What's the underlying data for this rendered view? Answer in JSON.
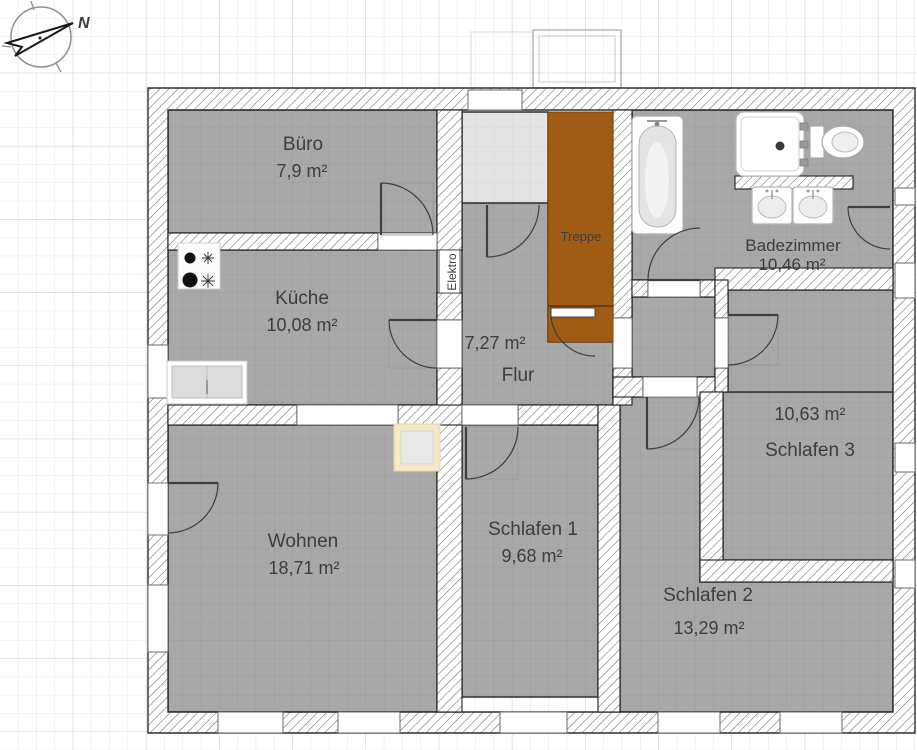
{
  "compass": {
    "north_label": "N"
  },
  "rooms": [
    {
      "id": "buero",
      "name": "Büro",
      "area": "7,9 m²"
    },
    {
      "id": "kueche",
      "name": "Küche",
      "area": "10,08 m²"
    },
    {
      "id": "wohnen",
      "name": "Wohnen",
      "area": "18,71 m²"
    },
    {
      "id": "flur",
      "name": "Flur",
      "area": "7,27 m²"
    },
    {
      "id": "schlafen-1",
      "name": "Schlafen 1",
      "area": "9,68 m²"
    },
    {
      "id": "schlafen-2",
      "name": "Schlafen 2",
      "area": "13,29 m²"
    },
    {
      "id": "schlafen-3",
      "name": "Schlafen 3",
      "area": "10,63 m²"
    },
    {
      "id": "badezimmer",
      "name": "Badezimmer",
      "area": "10,46 m²"
    }
  ],
  "labels": {
    "stairs": "Treppe",
    "electrical": "Elektro"
  },
  "colors": {
    "paper": "#ffffff",
    "grid_minor": "#e7e7e7",
    "grid_major": "#cfcfcf",
    "room_fill": "#a8a8a8",
    "vestibule_fill": "#e3e3e3",
    "stairs_brown": "#a05c14",
    "stairs_edge": "#6f3c08",
    "accent_beige": "#f6e8c6",
    "wall_outline": "#2e2e2e",
    "hatch_line": "#6a6a6a",
    "text": "#3d3d3d"
  }
}
